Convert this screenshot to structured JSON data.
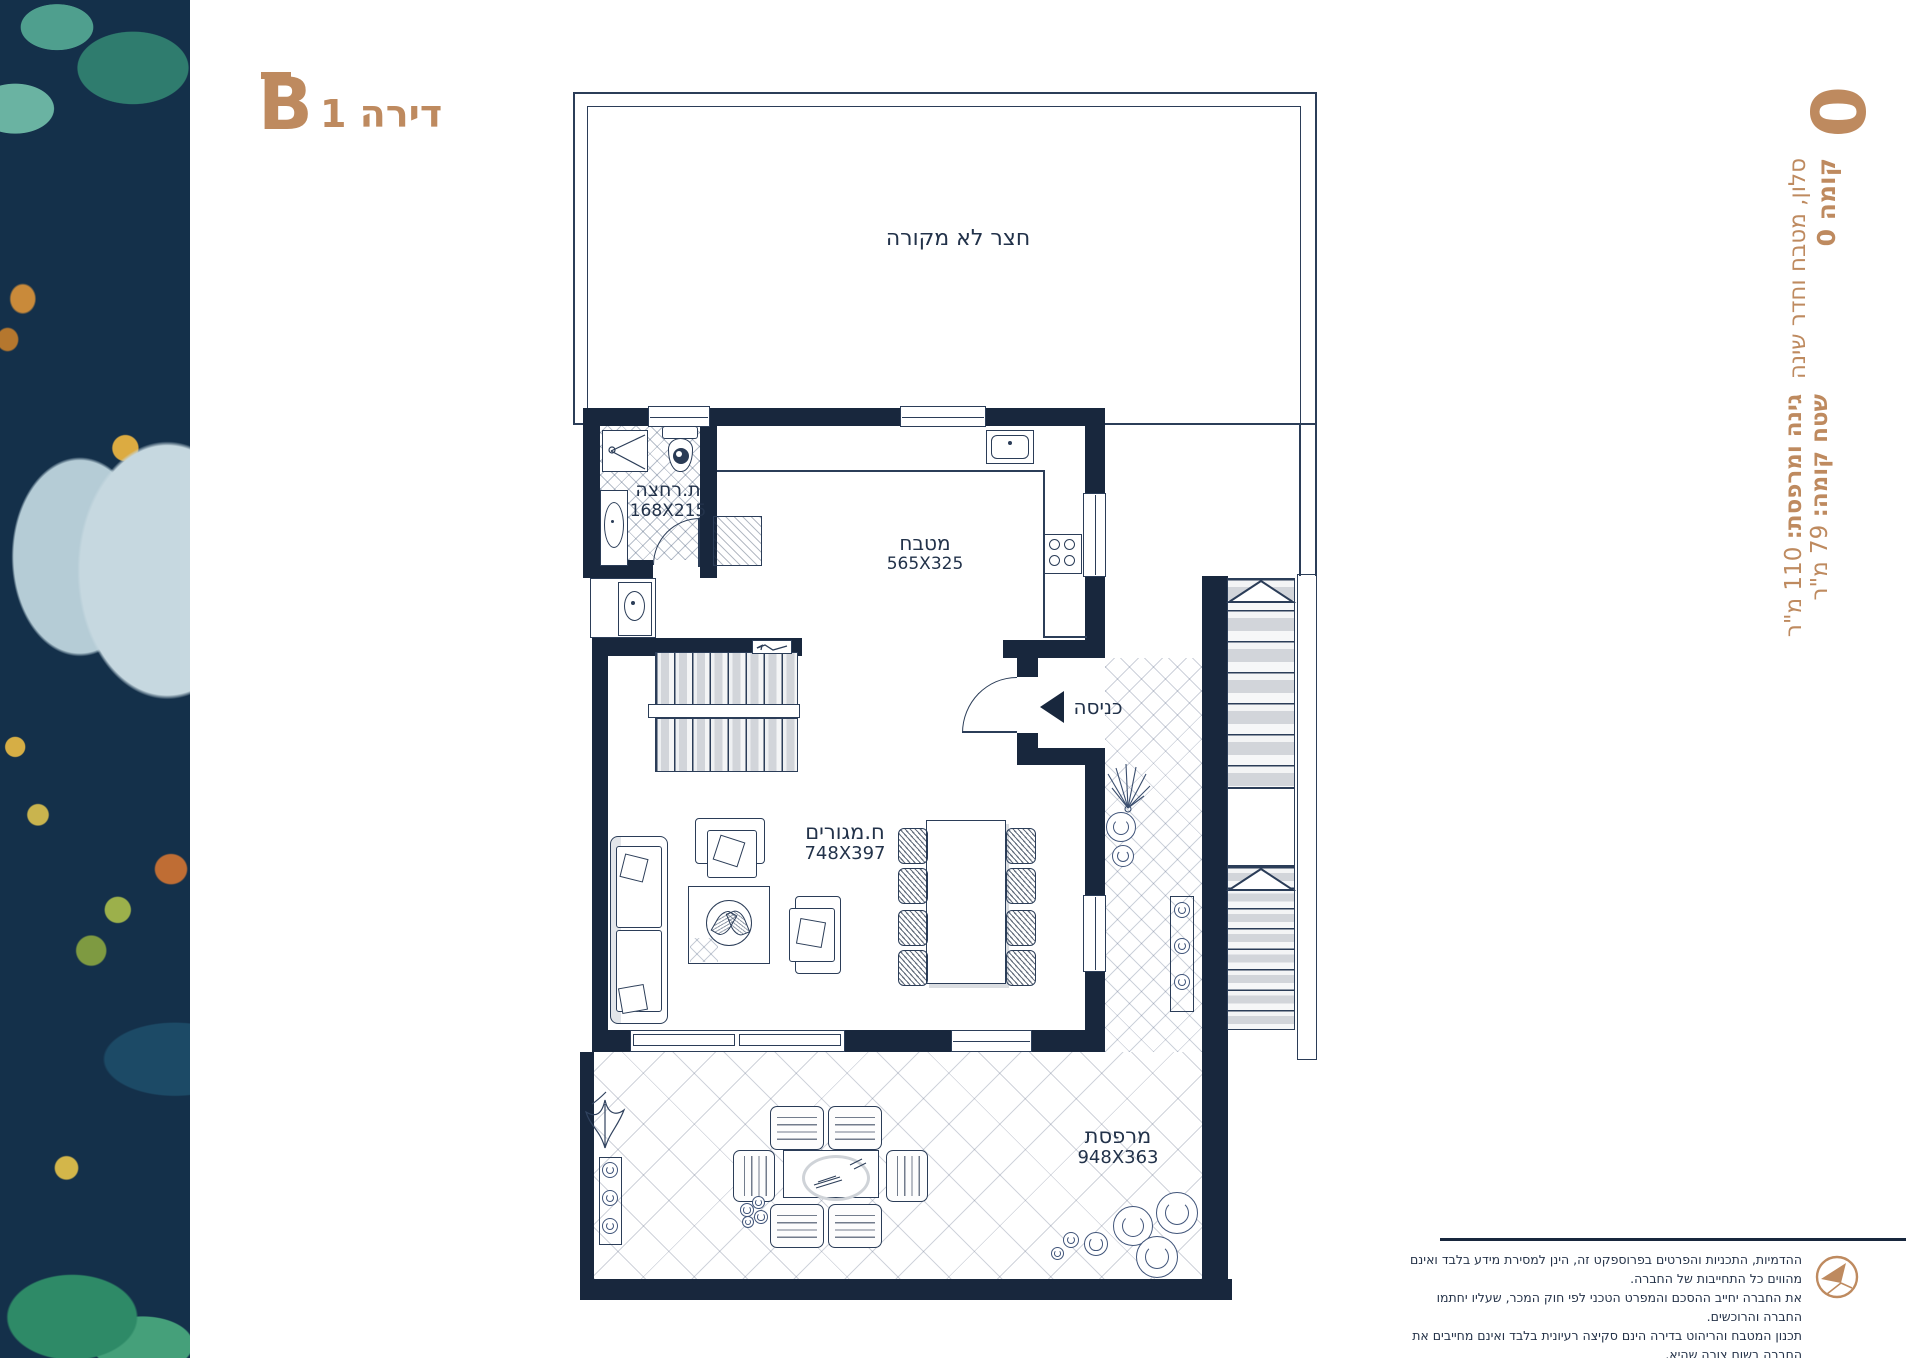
{
  "colors": {
    "accent": "#BE8A5F",
    "wall": "#18273D",
    "ink": "#22324A"
  },
  "header": {
    "unit_letter": "B",
    "apartment_label": "דירה 1"
  },
  "side_panel": {
    "floor_number_big": "0",
    "floor_line": "קומה 0",
    "rooms_line": "סלון, מטבח וחדר שינה",
    "floor_area_label": "שטח קומה:",
    "floor_area_value": "79 מ\"ר",
    "garden_area_label": "גינה ומרפסת:",
    "garden_area_value": "110 מ\"ר"
  },
  "plan": {
    "yard_label": "חצר לא מקורה",
    "bathroom": {
      "name": "ת.רחצה",
      "dims": "168X215"
    },
    "kitchen": {
      "name": "מטבח",
      "dims": "565X325"
    },
    "entrance_label": "כניסה",
    "living": {
      "name": "ח.מגורים",
      "dims": "748X397"
    },
    "balcony": {
      "name": "מרפסת",
      "dims": "948X363"
    }
  },
  "footer": {
    "disclaimer_lines": [
      "ההדמיות, התכניות והפרטים בפרוספקט זה, הינן למסירת מידע בלבד ואינם מהווים כל התחייבות של החברה.",
      "את החברה יחייב ההסכם והמפרט הטכני לפי חוק המכר, שעליו יחתמו החברה והרוכשים.",
      "תכנון המטבח והריהוט בדירה הינם סקיצה רעיונית בלבד ואינם מחייבים את החברה בשום צורה שהיא."
    ]
  }
}
